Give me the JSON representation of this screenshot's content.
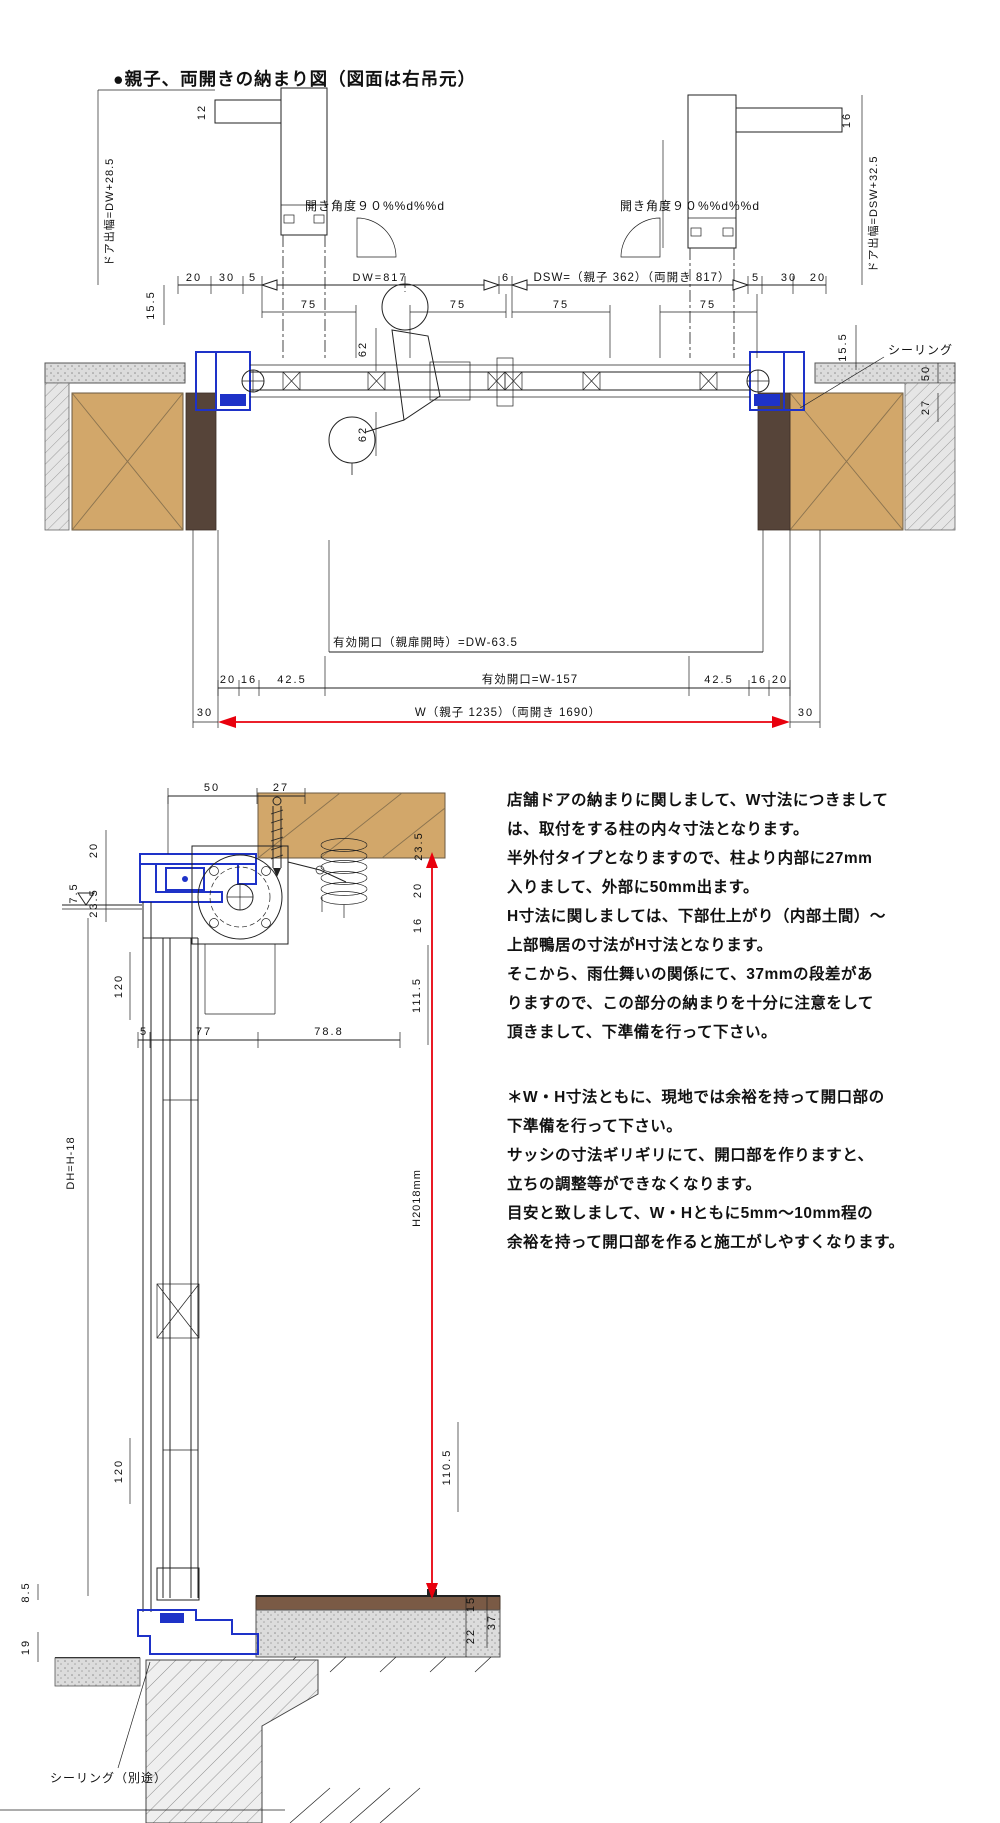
{
  "title": "●親子、両開きの納まり図（図面は右吊元）",
  "colors": {
    "dimension_red": "#e8000d",
    "frame_blue": "#1e32c8",
    "wood_tan": "#d2a76a",
    "wood_brown": "#564439"
  },
  "plan": {
    "door_offset_left": "ドア出幅=DW+28.5",
    "door_offset_right": "ドア出幅=DSW+32.5",
    "cap_left": "12",
    "cap_right": "16",
    "angle_left": "開き角度９０%%d%%d",
    "angle_right": "開き角度９０%%d%%d",
    "d20": "20",
    "d30": "30",
    "d5": "5",
    "d6": "6",
    "dw": "DW=817",
    "dsw": "DSW=（親子 362）（両開き 817）",
    "d75": "75",
    "d155": "15.5",
    "d62": "62",
    "sealing": "シーリング",
    "d50": "50",
    "d27": "27",
    "opening_parent": "有効開口（親扉開時）=DW-63.5",
    "opening_total": "有効開口=W-157",
    "d16": "16",
    "d425": "42.5",
    "d30b": "30",
    "w_total": "W（親子 1235）（両開き 1690）"
  },
  "section": {
    "d50": "50",
    "d27": "27",
    "d20": "20",
    "d75": "7.5",
    "d235": "23.5",
    "d16": "16",
    "d1115": "111.5",
    "d120": "120",
    "d5": "5",
    "d77": "77",
    "d788": "78.8",
    "dh": "DH=H-18",
    "h": "H2018mm",
    "d1105": "110.5",
    "d85": "8.5",
    "d19": "19",
    "d15": "15",
    "d22": "22",
    "d37": "37",
    "sealing_note": "シーリング（別途）"
  },
  "notes": {
    "p1": [
      "店舗ドアの納まりに関しまして、W寸法につきまして",
      "は、取付をする柱の内々寸法となります。",
      "半外付タイプとなりますので、柱より内部に27mm",
      "入りまして、外部に50mm出ます。",
      "H寸法に関しましては、下部仕上がり（内部土間）～",
      "上部鴨居の寸法がH寸法となります。",
      "そこから、雨仕舞いの関係にて、37mmの段差があ",
      "りますので、この部分の納まりを十分に注意をして",
      "頂きまして、下準備を行って下さい。"
    ],
    "p2": [
      "＊W・H寸法ともに、現地では余裕を持って開口部の",
      "下準備を行って下さい。",
      "サッシの寸法ギリギリにて、開口部を作りますと、",
      "立ちの調整等ができなくなります。",
      "目安と致しまして、W・Hともに5mm～10mm程の",
      "余裕を持って開口部を作ると施工がしやすくなります。"
    ]
  }
}
